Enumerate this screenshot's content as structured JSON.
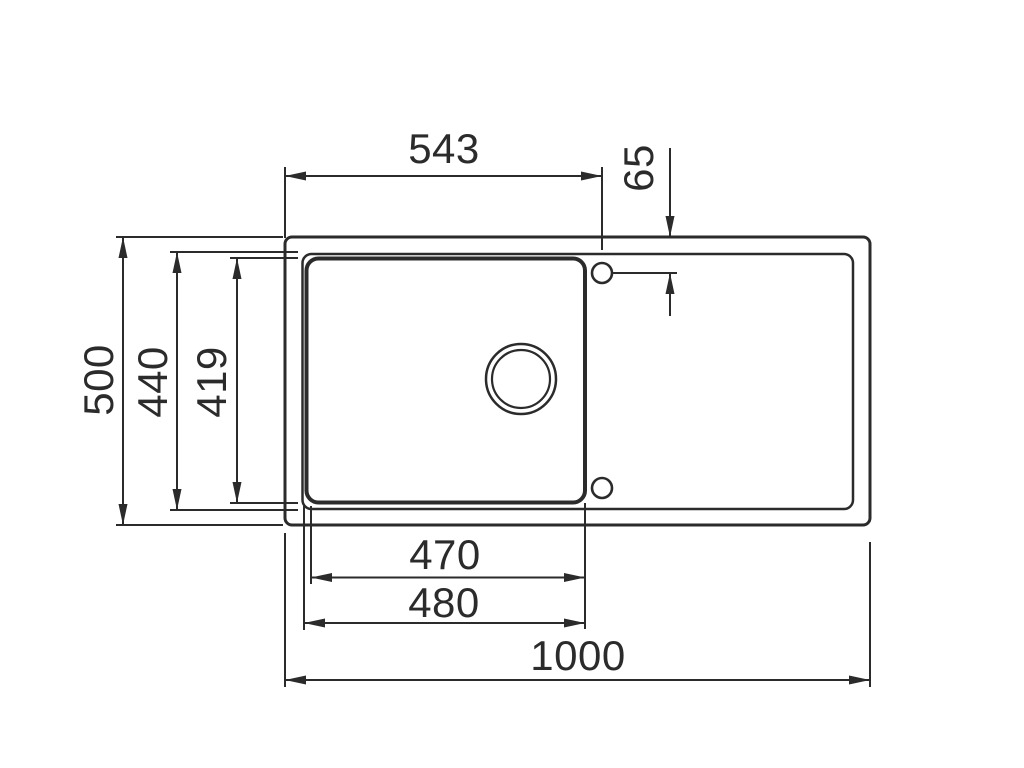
{
  "figure": {
    "type": "technical-dimension-drawing",
    "subject": "kitchen sink top view, single bowl with drainer, drain hole and two tap holes",
    "background_color": "#ffffff",
    "line_color": "#2b2b2b",
    "dimensions": {
      "overall_length": "1000",
      "overall_depth": "500",
      "rim_inner_depth": "440",
      "bowl_depth": "419",
      "bowl_inner_width": "470",
      "bowl_outer_width": "480",
      "left_edge_to_tap_hole": "543",
      "top_edge_to_tap_hole": "65"
    }
  }
}
